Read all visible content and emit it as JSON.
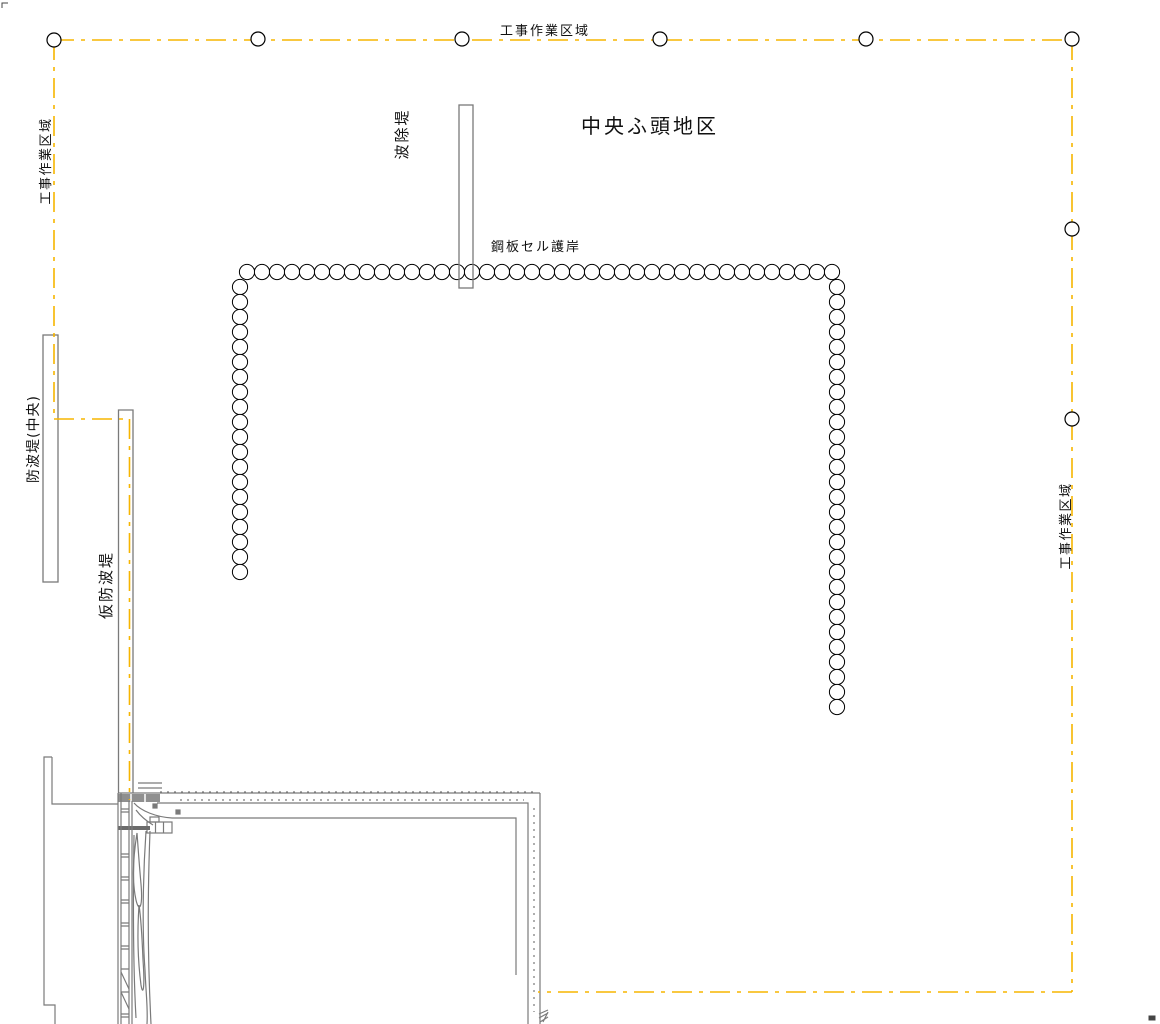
{
  "drawing": {
    "district_title": "中央ふ頭地区",
    "labels": {
      "work_area_top": "工事作業区域",
      "work_area_left": "工事作業区域",
      "work_area_right": "工事作業区域",
      "wave_dike": "波除堤",
      "steel_cell_revetment": "鋼板セル護岸",
      "breakwater_central": "防波堤(中央)",
      "temporary_breakwater": "仮防波堤"
    },
    "colors": {
      "boundary": "#F7B500",
      "structure": "#7a7a7a",
      "structure_dark": "#666666",
      "cell_stroke": "#000000",
      "text": "#111111",
      "background": "#ffffff"
    },
    "work_area_boundary": {
      "style": "dash-dot",
      "dash_pattern": "20 7 4 7",
      "segments": [
        [
          [
            54,
            40
          ],
          [
            1072,
            40
          ]
        ],
        [
          [
            1072,
            40
          ],
          [
            1072,
            992
          ]
        ],
        [
          [
            1072,
            992
          ],
          [
            538,
            992
          ]
        ],
        [
          [
            54,
            40
          ],
          [
            54,
            419
          ]
        ],
        [
          [
            54,
            419
          ],
          [
            129.5,
            419
          ]
        ],
        [
          [
            129.5,
            419
          ],
          [
            129.5,
            800
          ]
        ]
      ],
      "marker_radius": 7,
      "markers": [
        [
          54,
          40
        ],
        [
          258,
          39
        ],
        [
          462,
          39
        ],
        [
          660,
          39
        ],
        [
          866,
          39
        ],
        [
          1072,
          39
        ],
        [
          1072,
          229
        ],
        [
          1072,
          419
        ]
      ]
    },
    "steel_cell_wall": {
      "cell_radius": 7.6,
      "cell_spacing": 15,
      "rows": [
        {
          "name": "top-row",
          "axis": "x",
          "fixed": 272,
          "from": 247,
          "to": 832
        },
        {
          "name": "left-column",
          "axis": "y",
          "fixed": 240,
          "from": 287,
          "to": 572
        },
        {
          "name": "right-column",
          "axis": "y",
          "fixed": 837,
          "from": 287,
          "to": 707
        }
      ]
    }
  }
}
